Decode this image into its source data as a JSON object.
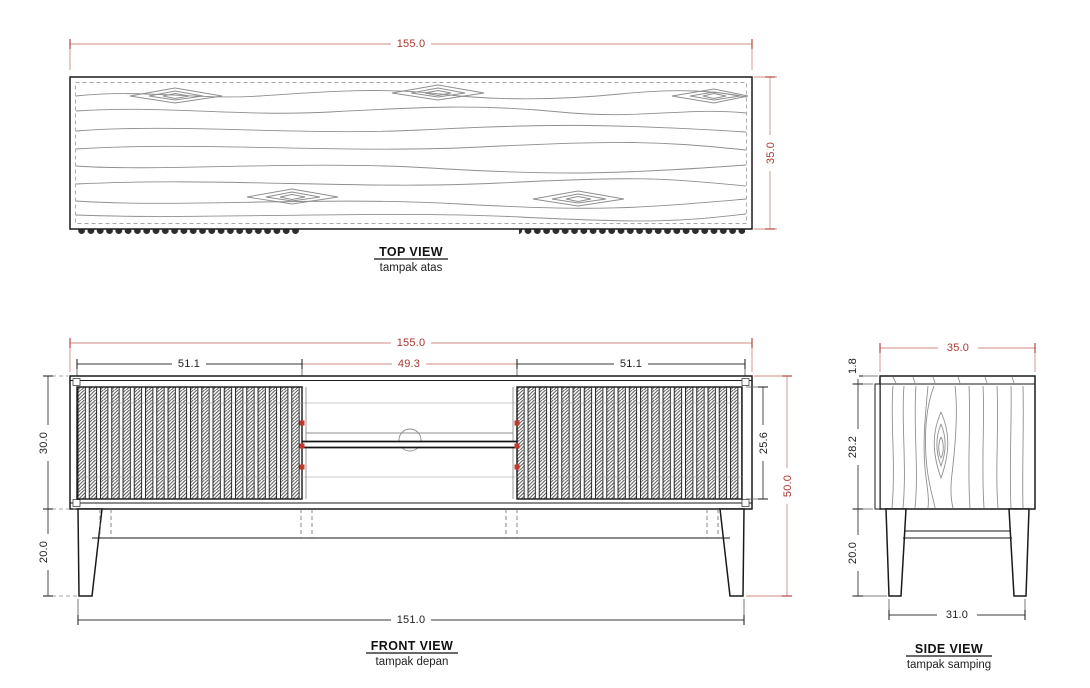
{
  "drawing": {
    "top_view": {
      "title": "TOP VIEW",
      "subtitle": "tampak atas",
      "dims": {
        "width": "155.0",
        "depth": "35.0"
      }
    },
    "front_view": {
      "title": "FRONT VIEW",
      "subtitle": "tampak depan",
      "dims": {
        "overall_width": "155.0",
        "left_door_width": "51.1",
        "center_width": "49.3",
        "right_door_width": "51.1",
        "body_height": "30.0",
        "leg_height": "20.0",
        "door_height": "25.6",
        "overall_height": "50.0",
        "base_width": "151.0"
      }
    },
    "side_view": {
      "title": "SIDE VIEW",
      "subtitle": "tampak samping",
      "dims": {
        "depth": "35.0",
        "top_thickness": "1.8",
        "body_height": "28.2",
        "leg_height": "20.0",
        "base_depth": "31.0"
      }
    },
    "colors": {
      "accent_red": "#a9382f",
      "dim_line_red": "#cf8d85",
      "line_black": "#1a1a1a",
      "grain_gray": "#8f8f8f",
      "hinge_red": "#c0392b",
      "background": "#ffffff"
    }
  }
}
